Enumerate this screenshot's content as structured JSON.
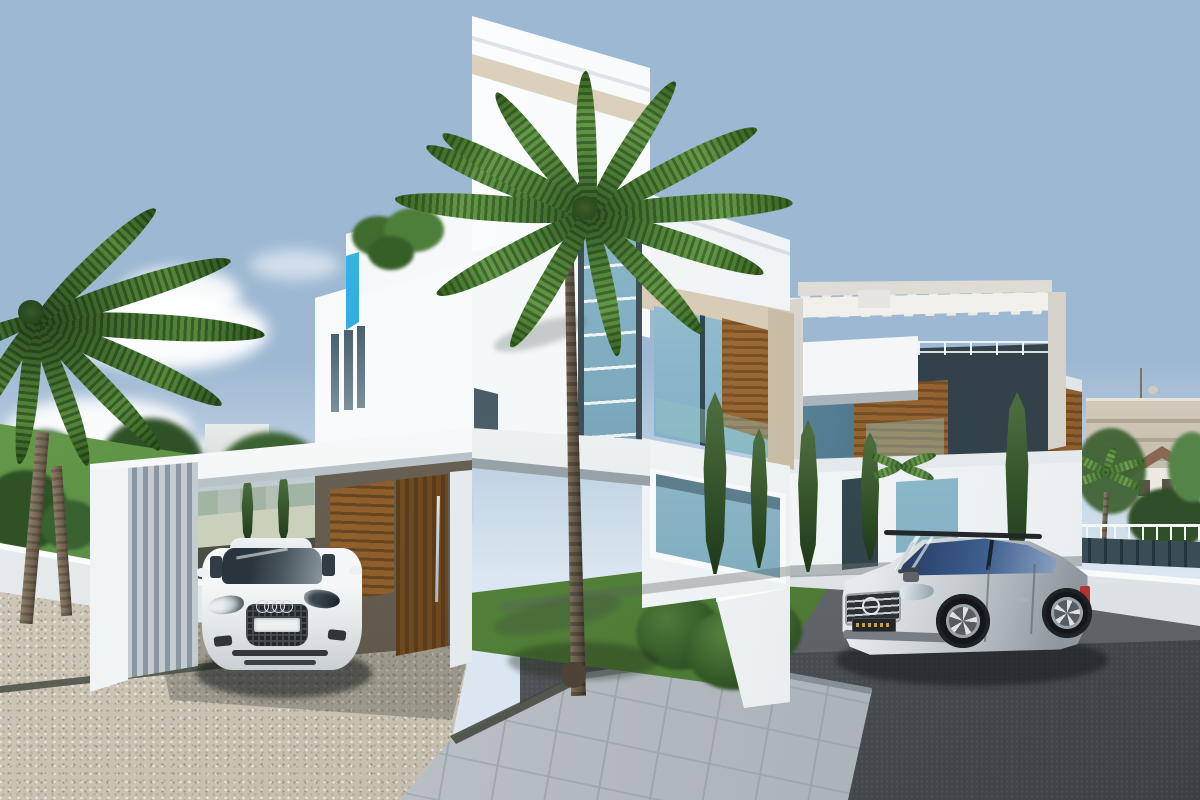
{
  "scene": {
    "type": "architectural_exterior_render",
    "time_of_day": "day",
    "description": "Photorealistic 3D render of two modern white cubist villas with timber accents: a three-storey villa with carport sheltering a white Audi TT coupe, a second villa with rooftop pergola, a silver Mercedes ML SUV on an asphalt drive, palm trees, cypresses, lawns, a pebble driveway, a paved tile walkway and a blue sky with scattered cumulus clouds.",
    "labels": {
      "sky": "Blue sky gradient with scattered clouds",
      "clouds": "Cumulus clouds over the horizon",
      "background_left": "Distant trees and white apartment building",
      "background_right": "Beige apartment block, pitched-roof house, palms and dark fence",
      "main_villa": "Three-storey white cubist villa with cream trim, glass stair strip and timber-clad window bay",
      "roof_terrace": "Roof terrace with planter greenery and cyan glass balustrade",
      "carport": "White cantilevered carport canopy with grey louvre screen",
      "entrance_door": "Tall timber entrance door with steel pull handle",
      "audi": "White Audi TT coupe parked under the carport",
      "second_villa": "Two-storey white villa with rooftop pergola, balcony and timber panels",
      "pergola": "Open white pergola frame on roof terrace",
      "mercedes": "Silver Mercedes ML SUV parked on the asphalt drive",
      "palm_center": "Tall palm tree in front of the main villa",
      "palm_left": "Palm tree at the left garden",
      "lawn": "Green lawn behind the low white garden wall",
      "garden": "Planting bed with shrub and yucca",
      "driveway_pebble": "Exposed-aggregate pebble driveway",
      "walkway_tiles": "Grey concrete tile walkway",
      "driveway_asphalt": "Dark asphalt driveway",
      "boundary_wall": "Low white boundary wall",
      "drain": "Linear drainage channel"
    }
  },
  "palette": {
    "sky_deep": "#2f6bab",
    "sky_pale": "#d8e4ee",
    "wall_white": "#f5f7f8",
    "wall_shade": "#dfe5e8",
    "trim_cream": "#d8cdb8",
    "wood": "#9c6a32",
    "wood_dark": "#5e3d1c",
    "door_wood": "#6b4a26",
    "glass_teal": "#7fb2c6",
    "glass_deep": "#3c606e",
    "balustrade_cyan": "#2fb0e0",
    "grass": "#66994a",
    "grass_dark": "#47732f",
    "foliage": "#3f6434",
    "cypress": "#2c4a24",
    "pebble": "#cfc9bc",
    "tile": "#b8bec4",
    "asphalt": "#4b5055",
    "fence_dark": "#2c3a40",
    "roof_terracotta": "#8a6752",
    "car_silver": "#c3c9cd",
    "car_white": "#f2f4f5"
  }
}
